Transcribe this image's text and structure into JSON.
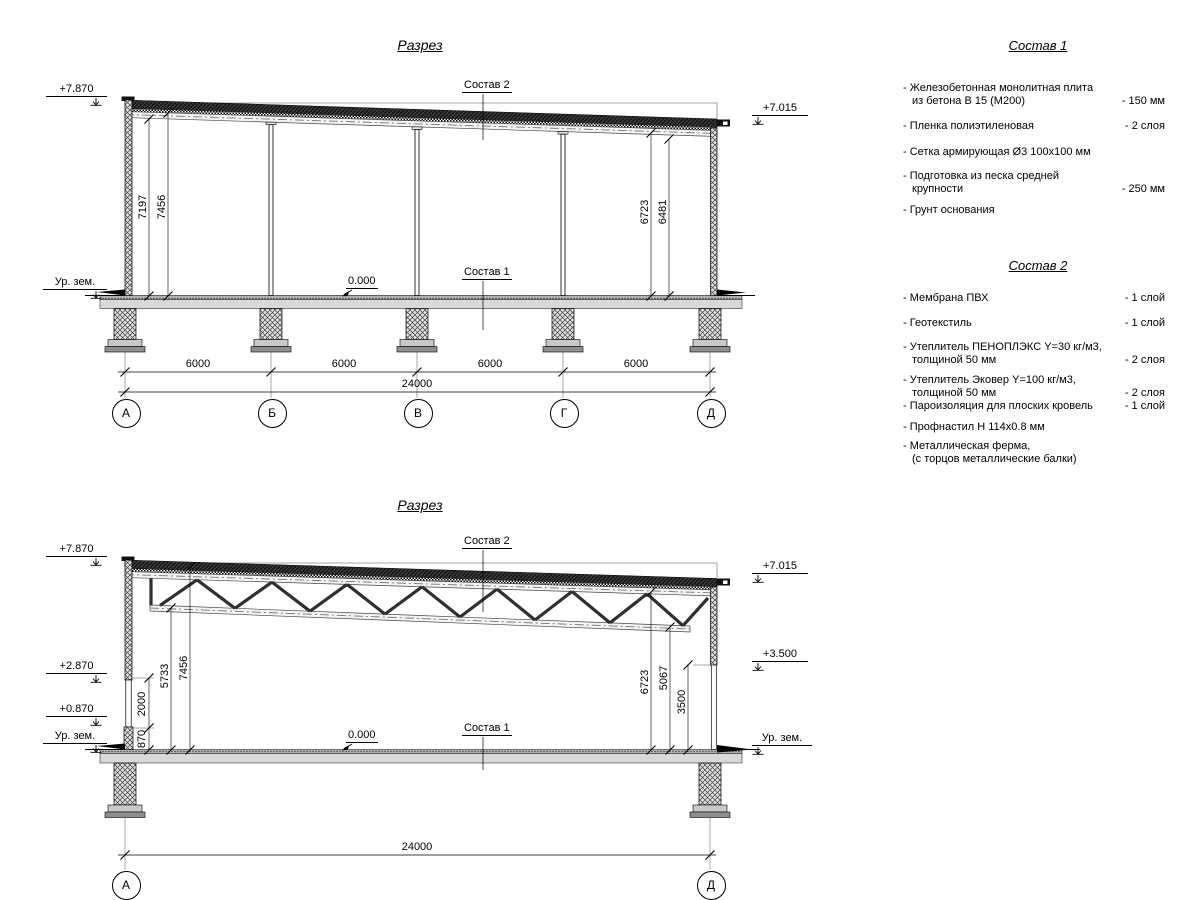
{
  "section1": {
    "title": "Разрез",
    "composition2_callout": "Состав 2",
    "composition1_callout": "Состав 1",
    "zero_level": "0.000",
    "elevations": {
      "left_top": "+7.870",
      "left_ground": "Ур. зем.",
      "right_top": "+7.015"
    },
    "vertical_dims": {
      "left_inner": "7197",
      "left_outer": "7456",
      "right_inner": "6723",
      "right_outer": "6481"
    },
    "span_dims": [
      "6000",
      "6000",
      "6000",
      "6000"
    ],
    "total_dim": "24000",
    "axes": [
      "А",
      "Б",
      "В",
      "Г",
      "Д"
    ]
  },
  "section2": {
    "title": "Разрез",
    "composition2_callout": "Состав 2",
    "composition1_callout": "Состав 1",
    "zero_level": "0.000",
    "elevations": {
      "left_top": "+7.870",
      "left_mid": "+2.870",
      "left_low": "+0.870",
      "left_ground": "Ур. зем.",
      "right_top": "+7.015",
      "right_mid": "+3.500",
      "right_ground": "Ур. зем."
    },
    "vertical_dims": {
      "d2000": "2000",
      "d870": "870",
      "d5733": "5733",
      "d7456": "7456",
      "d6723": "6723",
      "d5067": "5067",
      "d3500": "3500"
    },
    "total_dim": "24000",
    "axes": [
      "А",
      "Д"
    ]
  },
  "composition1": {
    "title": "Состав 1",
    "items": [
      {
        "name": "- Железобетонная  монолитная плита\nиз бетона В 15 (М200)",
        "value": "- 150 мм"
      },
      {
        "name": "- Пленка полиэтиленовая",
        "value": "- 2 слоя"
      },
      {
        "name": "- Сетка армирующая Ø3 100х100 мм",
        "value": ""
      },
      {
        "name": "- Подготовка из песка средней\nкрупности",
        "value": "- 250 мм"
      },
      {
        "name": "- Грунт основания",
        "value": ""
      }
    ]
  },
  "composition2": {
    "title": "Состав 2",
    "items": [
      {
        "name": "- Мембрана ПВХ",
        "value": "- 1 слой"
      },
      {
        "name": "- Геотекстиль",
        "value": "- 1 слой"
      },
      {
        "name": "- Утеплитель ПЕНОПЛЭКС Y=30 кг/м3,\nтолщиной 50 мм",
        "value": "- 2 слоя"
      },
      {
        "name": "- Утеплитель Эковер Y=100 кг/м3,\nтолщиной 50 мм",
        "value": "- 2 слоя"
      },
      {
        "name": "- Пароизоляция для плоских кровель",
        "value": "- 1 слой"
      },
      {
        "name": "- Профнастил Н 114х0.8 мм",
        "value": ""
      },
      {
        "name": "- Металлическая ферма,\n(с торцов металлические балки)",
        "value": ""
      }
    ]
  }
}
